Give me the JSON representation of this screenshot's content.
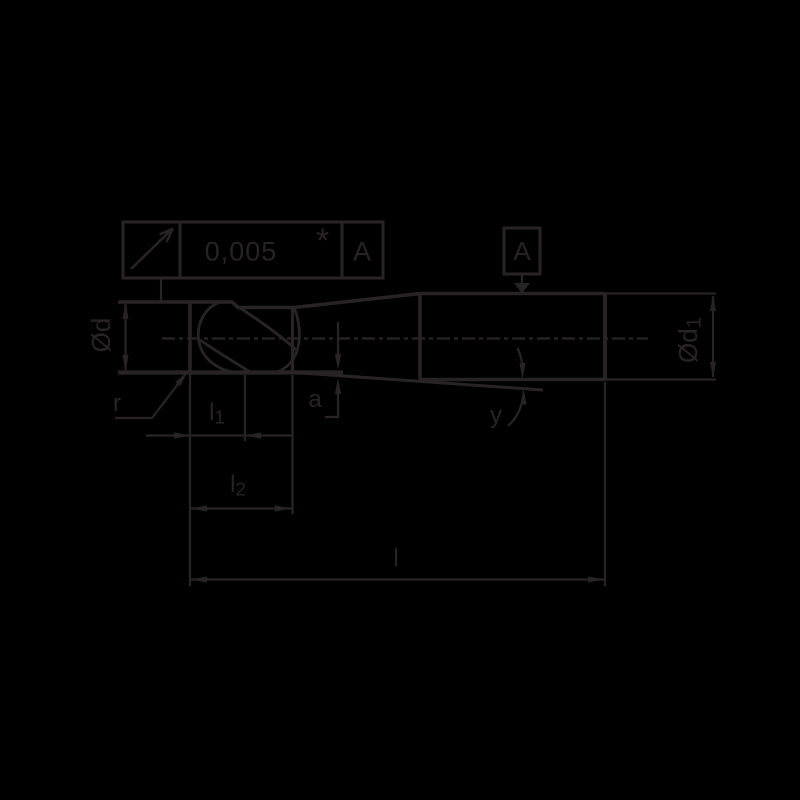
{
  "drawing": {
    "kind": "technical-tool-drawing",
    "ink_color": "#282425",
    "background_color": "#000000"
  },
  "feature_control_frame": {
    "symbol": "circular-runout-arrow",
    "tolerance_value": "0,005",
    "footnote_marker": "*",
    "datum_reference": "A"
  },
  "datum_flag": {
    "letter": "A"
  },
  "labels": {
    "head_diameter": "Ød",
    "shank_diameter": {
      "text": "Ød",
      "sub": "1"
    },
    "corner_radius": "r",
    "flute_length": {
      "text": "l",
      "sub": "1"
    },
    "cut_length": {
      "text": "l",
      "sub": "2"
    },
    "overall_length": "l",
    "axial_offset": "a",
    "taper_angle": "y"
  }
}
